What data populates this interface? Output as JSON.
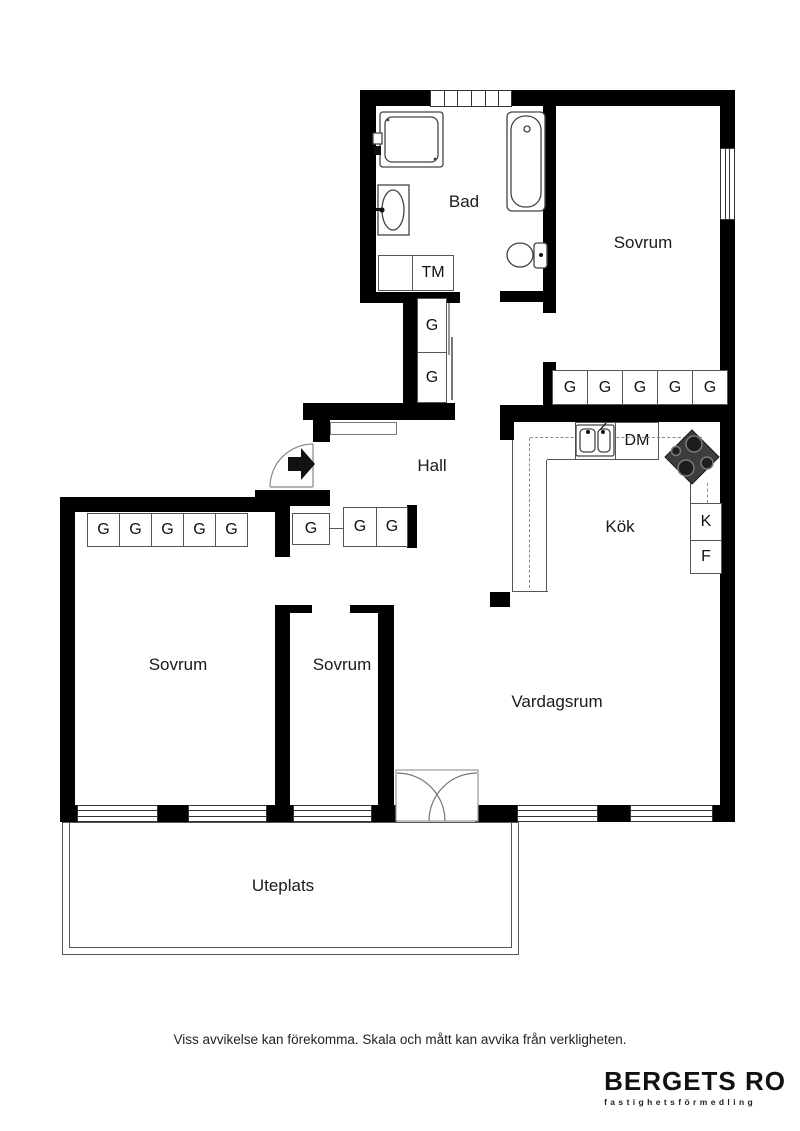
{
  "plan": {
    "rooms": {
      "bad": "Bad",
      "sovrum_right": "Sovrum",
      "sovrum_left": "Sovrum",
      "sovrum_mid": "Sovrum",
      "hall": "Hall",
      "kok": "Kök",
      "vardagsrum": "Vardagsrum",
      "uteplats": "Uteplats"
    },
    "units": {
      "tm": "TM",
      "dm": "DM",
      "k": "K",
      "f": "F",
      "g": "G"
    }
  },
  "footer": {
    "disclaimer": "Viss avvikelse kan förekomma. Skala och mått kan avvika från verkligheten."
  },
  "brand": {
    "name": "BERGETS RO",
    "tagline": "fastighetsförmedling"
  },
  "colors": {
    "wall": "#000000",
    "fixture_line": "#555555",
    "stove_fill": "#3d3d3d"
  }
}
